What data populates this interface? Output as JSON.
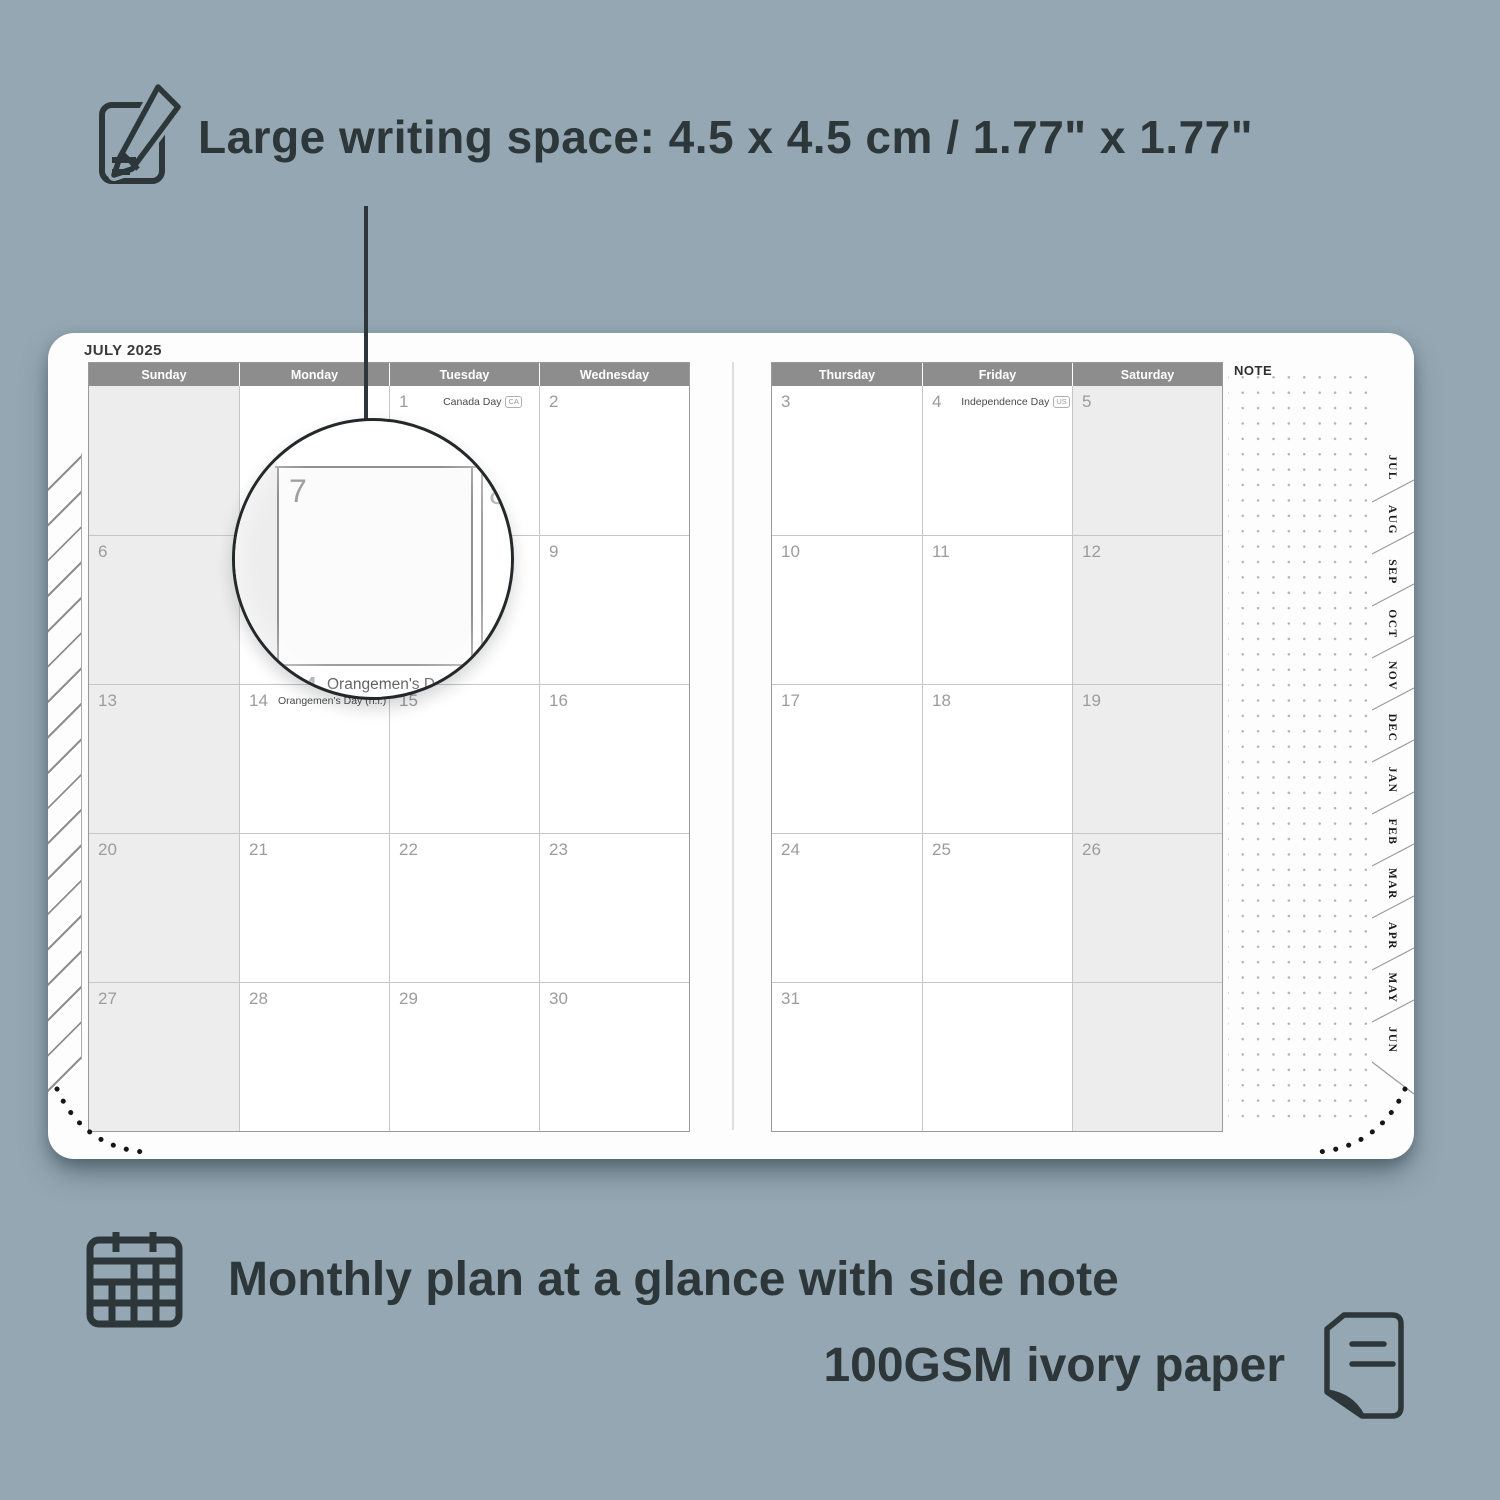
{
  "feature_top": {
    "text": "Large writing space: 4.5 x 4.5 cm / 1.77\" x 1.77\""
  },
  "feature_bottom": {
    "line1": "Monthly plan at a glance with side note",
    "line2": "100GSM ivory paper"
  },
  "planner": {
    "month_title": "JULY 2025",
    "note_label": "NOTE",
    "left_headers": [
      "Sunday",
      "Monday",
      "Tuesday",
      "Wednesday"
    ],
    "right_headers": [
      "Thursday",
      "Friday",
      "Saturday"
    ],
    "left_rows": [
      [
        {
          "day": ""
        },
        {
          "day": ""
        },
        {
          "day": "1",
          "holiday": "Canada Day",
          "badge": "CA"
        },
        {
          "day": "2"
        }
      ],
      [
        {
          "day": "6"
        },
        {
          "day": "7"
        },
        {
          "day": "8"
        },
        {
          "day": "9"
        }
      ],
      [
        {
          "day": "13"
        },
        {
          "day": "14",
          "holiday": "Orangemen's Day (n.i.)",
          "badge": "UK"
        },
        {
          "day": "15"
        },
        {
          "day": "16"
        }
      ],
      [
        {
          "day": "20"
        },
        {
          "day": "21"
        },
        {
          "day": "22"
        },
        {
          "day": "23"
        }
      ],
      [
        {
          "day": "27"
        },
        {
          "day": "28"
        },
        {
          "day": "29"
        },
        {
          "day": "30"
        }
      ]
    ],
    "right_rows": [
      [
        {
          "day": "3"
        },
        {
          "day": "4",
          "holiday": "Independence Day",
          "badge": "US"
        },
        {
          "day": "5"
        }
      ],
      [
        {
          "day": "10"
        },
        {
          "day": "11"
        },
        {
          "day": "12"
        }
      ],
      [
        {
          "day": "17"
        },
        {
          "day": "18"
        },
        {
          "day": "19"
        }
      ],
      [
        {
          "day": "24"
        },
        {
          "day": "25"
        },
        {
          "day": "26"
        }
      ],
      [
        {
          "day": "31"
        },
        {
          "day": ""
        },
        {
          "day": ""
        }
      ]
    ],
    "tabs": [
      "JUL",
      "AUG",
      "SEP",
      "OCT",
      "NOV",
      "DEC",
      "JAN",
      "FEB",
      "MAR",
      "APR",
      "MAY",
      "JUN"
    ]
  },
  "lens": {
    "day_left": "7",
    "day_right": "8",
    "footer_day": "14",
    "footer_text": "Orangemen's Day (n.i.)",
    "footer_badge": "UK"
  },
  "colors": {
    "background": "#94a7b2",
    "ink": "#2d373a",
    "header_bg": "#8d8d8d",
    "weekend_bg": "#ededed",
    "grid_border": "#9a9a9a"
  }
}
